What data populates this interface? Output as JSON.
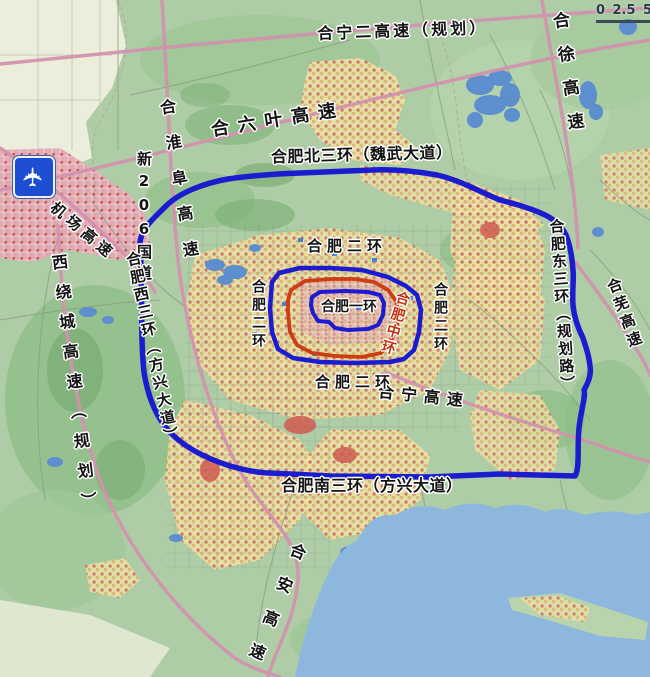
{
  "map": {
    "scale_bar": {
      "tick0": "0",
      "tick1": "2.5",
      "tick2": "5"
    },
    "icons": {
      "airport": "✈"
    },
    "colors": {
      "ring_blue": "#1b1bd0",
      "ring_mid_red": "#cd3d12",
      "expressway_pink": "#d292ae",
      "water_blue": "#6f9fd6",
      "lake_blue": "#8db7dd",
      "label_red": "#c43110"
    },
    "labels": {
      "hening2_expwy": "合宁二高速（规划）",
      "hexu_expwy": "合徐高速",
      "heliuye_expwy": "合六叶高速",
      "hehuaifu_expwy": "合淮阜高速",
      "xin206_road": "新206国道",
      "airport_expwy": "机场高速",
      "north_3rd_ring": "合肥北三环（魏武大道）",
      "west_ring_expwy": "西绕城高速（规划）",
      "west_3rd_ring": "合肥西三环（方兴大道）",
      "east_3rd_ring": "合肥东三环（规划路）",
      "south_3rd_ring": "合肥南三环（方兴大道）",
      "hewu_expwy": "合芜高速",
      "hening_expwy": "合宁高速",
      "hean_expwy": "合安高速",
      "second_ring": "合肥二环",
      "first_ring": "合肥一环",
      "middle_ring": "合肥中环"
    }
  }
}
